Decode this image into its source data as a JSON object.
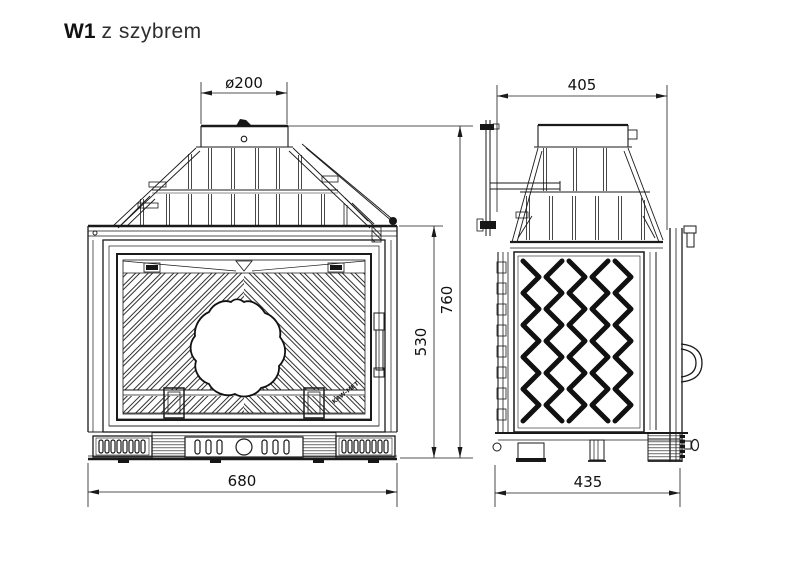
{
  "page": {
    "background": "#ffffff",
    "line_color": "#1a1a1a"
  },
  "title": {
    "model": "W1",
    "variant": "z szybrem"
  },
  "drawing": {
    "front_view": {
      "name": "front view",
      "logo": "KAW-MET",
      "dimensions": {
        "flue_diameter": "ø200",
        "overall_width": "680",
        "overall_height": "760",
        "firebox_height": "530"
      }
    },
    "side_view": {
      "name": "side view",
      "dimensions": {
        "top_depth": "405",
        "base_depth": "435"
      }
    }
  }
}
